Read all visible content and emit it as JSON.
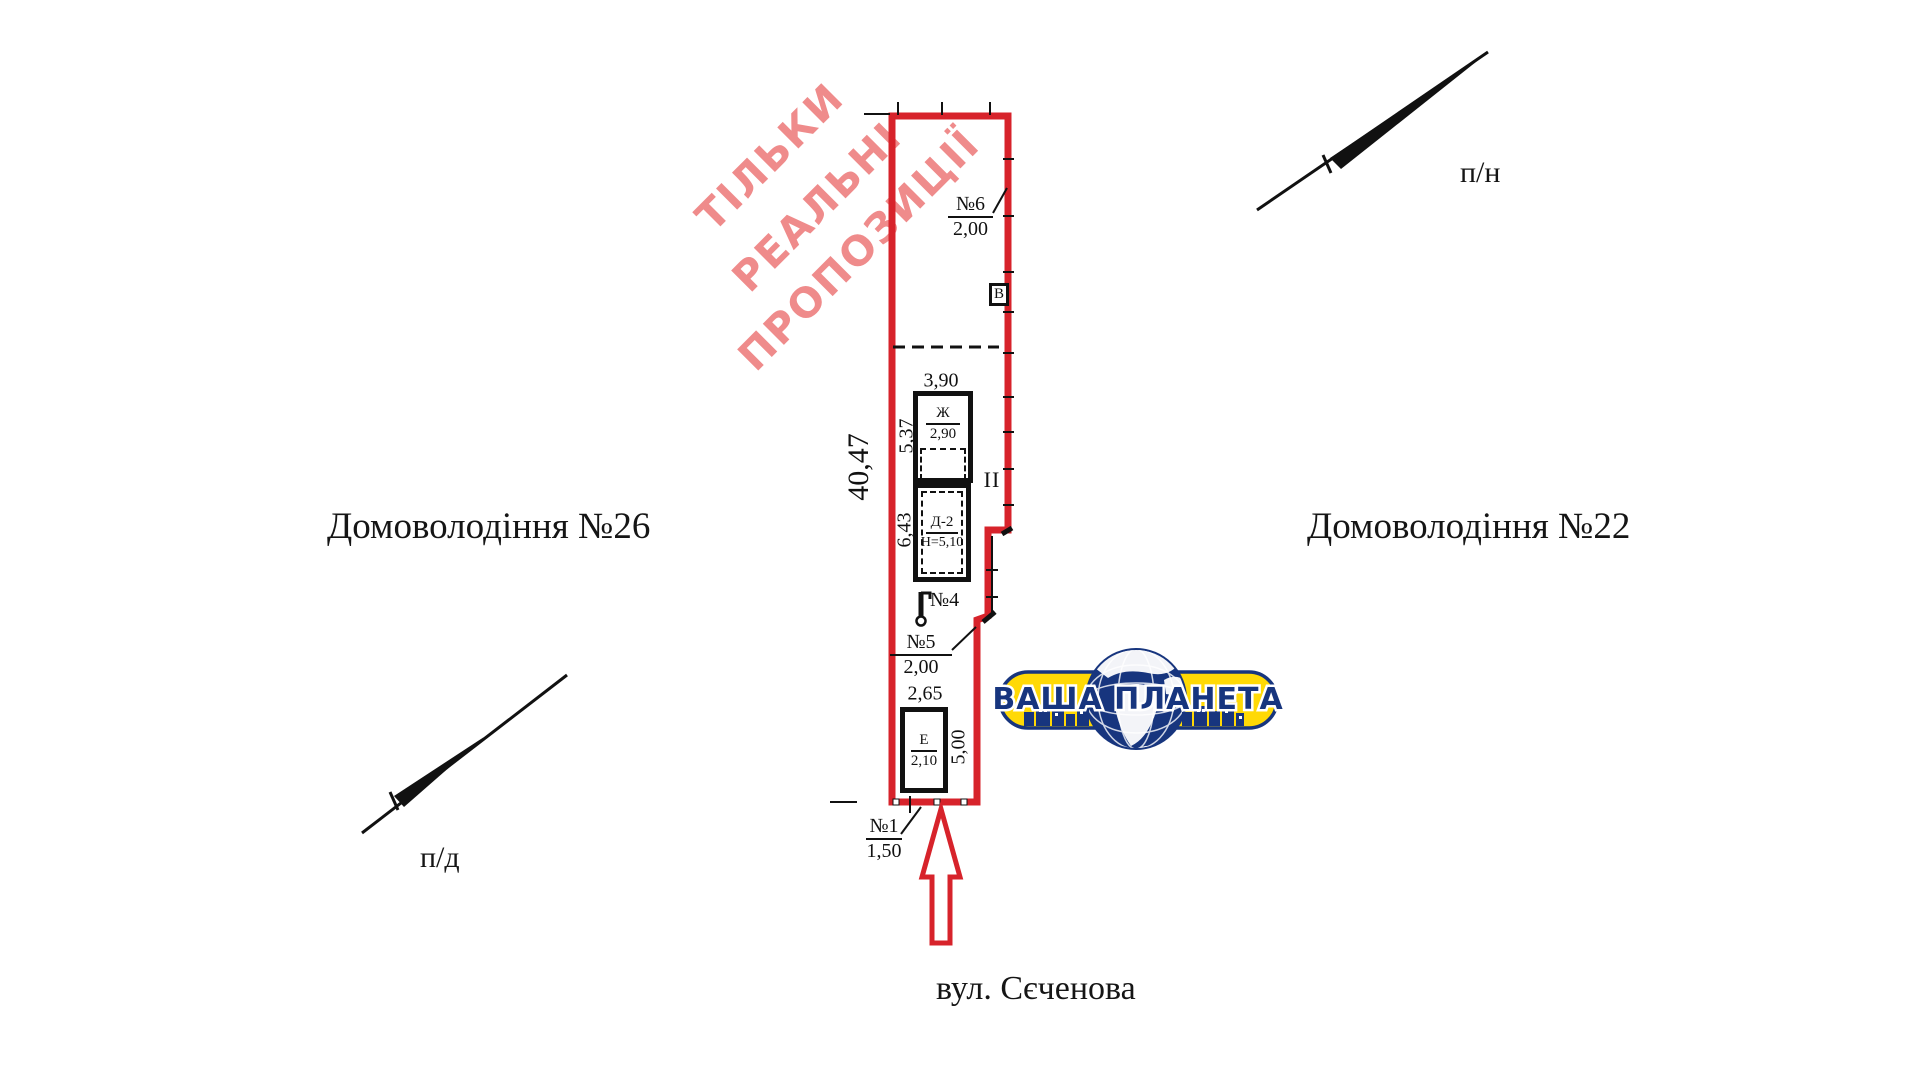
{
  "colors": {
    "boundary_red": "#d7232b",
    "ink": "#111111",
    "watermark_pink": "#ef8b8b",
    "logo_yellow": "#ffd905",
    "logo_navy": "#17357e"
  },
  "watermark": {
    "line1": "ТІЛЬКИ",
    "line2": "РЕАЛЬНІ",
    "line3": "ПРОПОЗИЦІЇ"
  },
  "surroundings": {
    "left_property": "Домоволодіння №26",
    "right_property": "Домоволодіння №22",
    "street": "вул. Сєченова",
    "north_direction": "п/н",
    "south_direction": "п/д"
  },
  "plan": {
    "overall_length": "40,47",
    "segment_upper": "5,37",
    "segment_lower": "6,43",
    "width_top": "3,90",
    "width_bottom": "2,65",
    "depth_right": "5,00",
    "section": "II",
    "point_6": {
      "label": "№6",
      "value": "2,00"
    },
    "point_5": {
      "label": "№5",
      "value": "2,00"
    },
    "point_4": {
      "label": "№4"
    },
    "point_1": {
      "label": "№1",
      "value": "1,50"
    },
    "building_zh": {
      "label": "Ж",
      "value": "2,90"
    },
    "building_d2": {
      "label": "Д-2",
      "value": "Н=5,10"
    },
    "building_e": {
      "label": "Е",
      "value": "2,10"
    },
    "building_v": {
      "label": "В"
    }
  },
  "logo": {
    "text": "ВАША ПЛАНЕТА"
  }
}
